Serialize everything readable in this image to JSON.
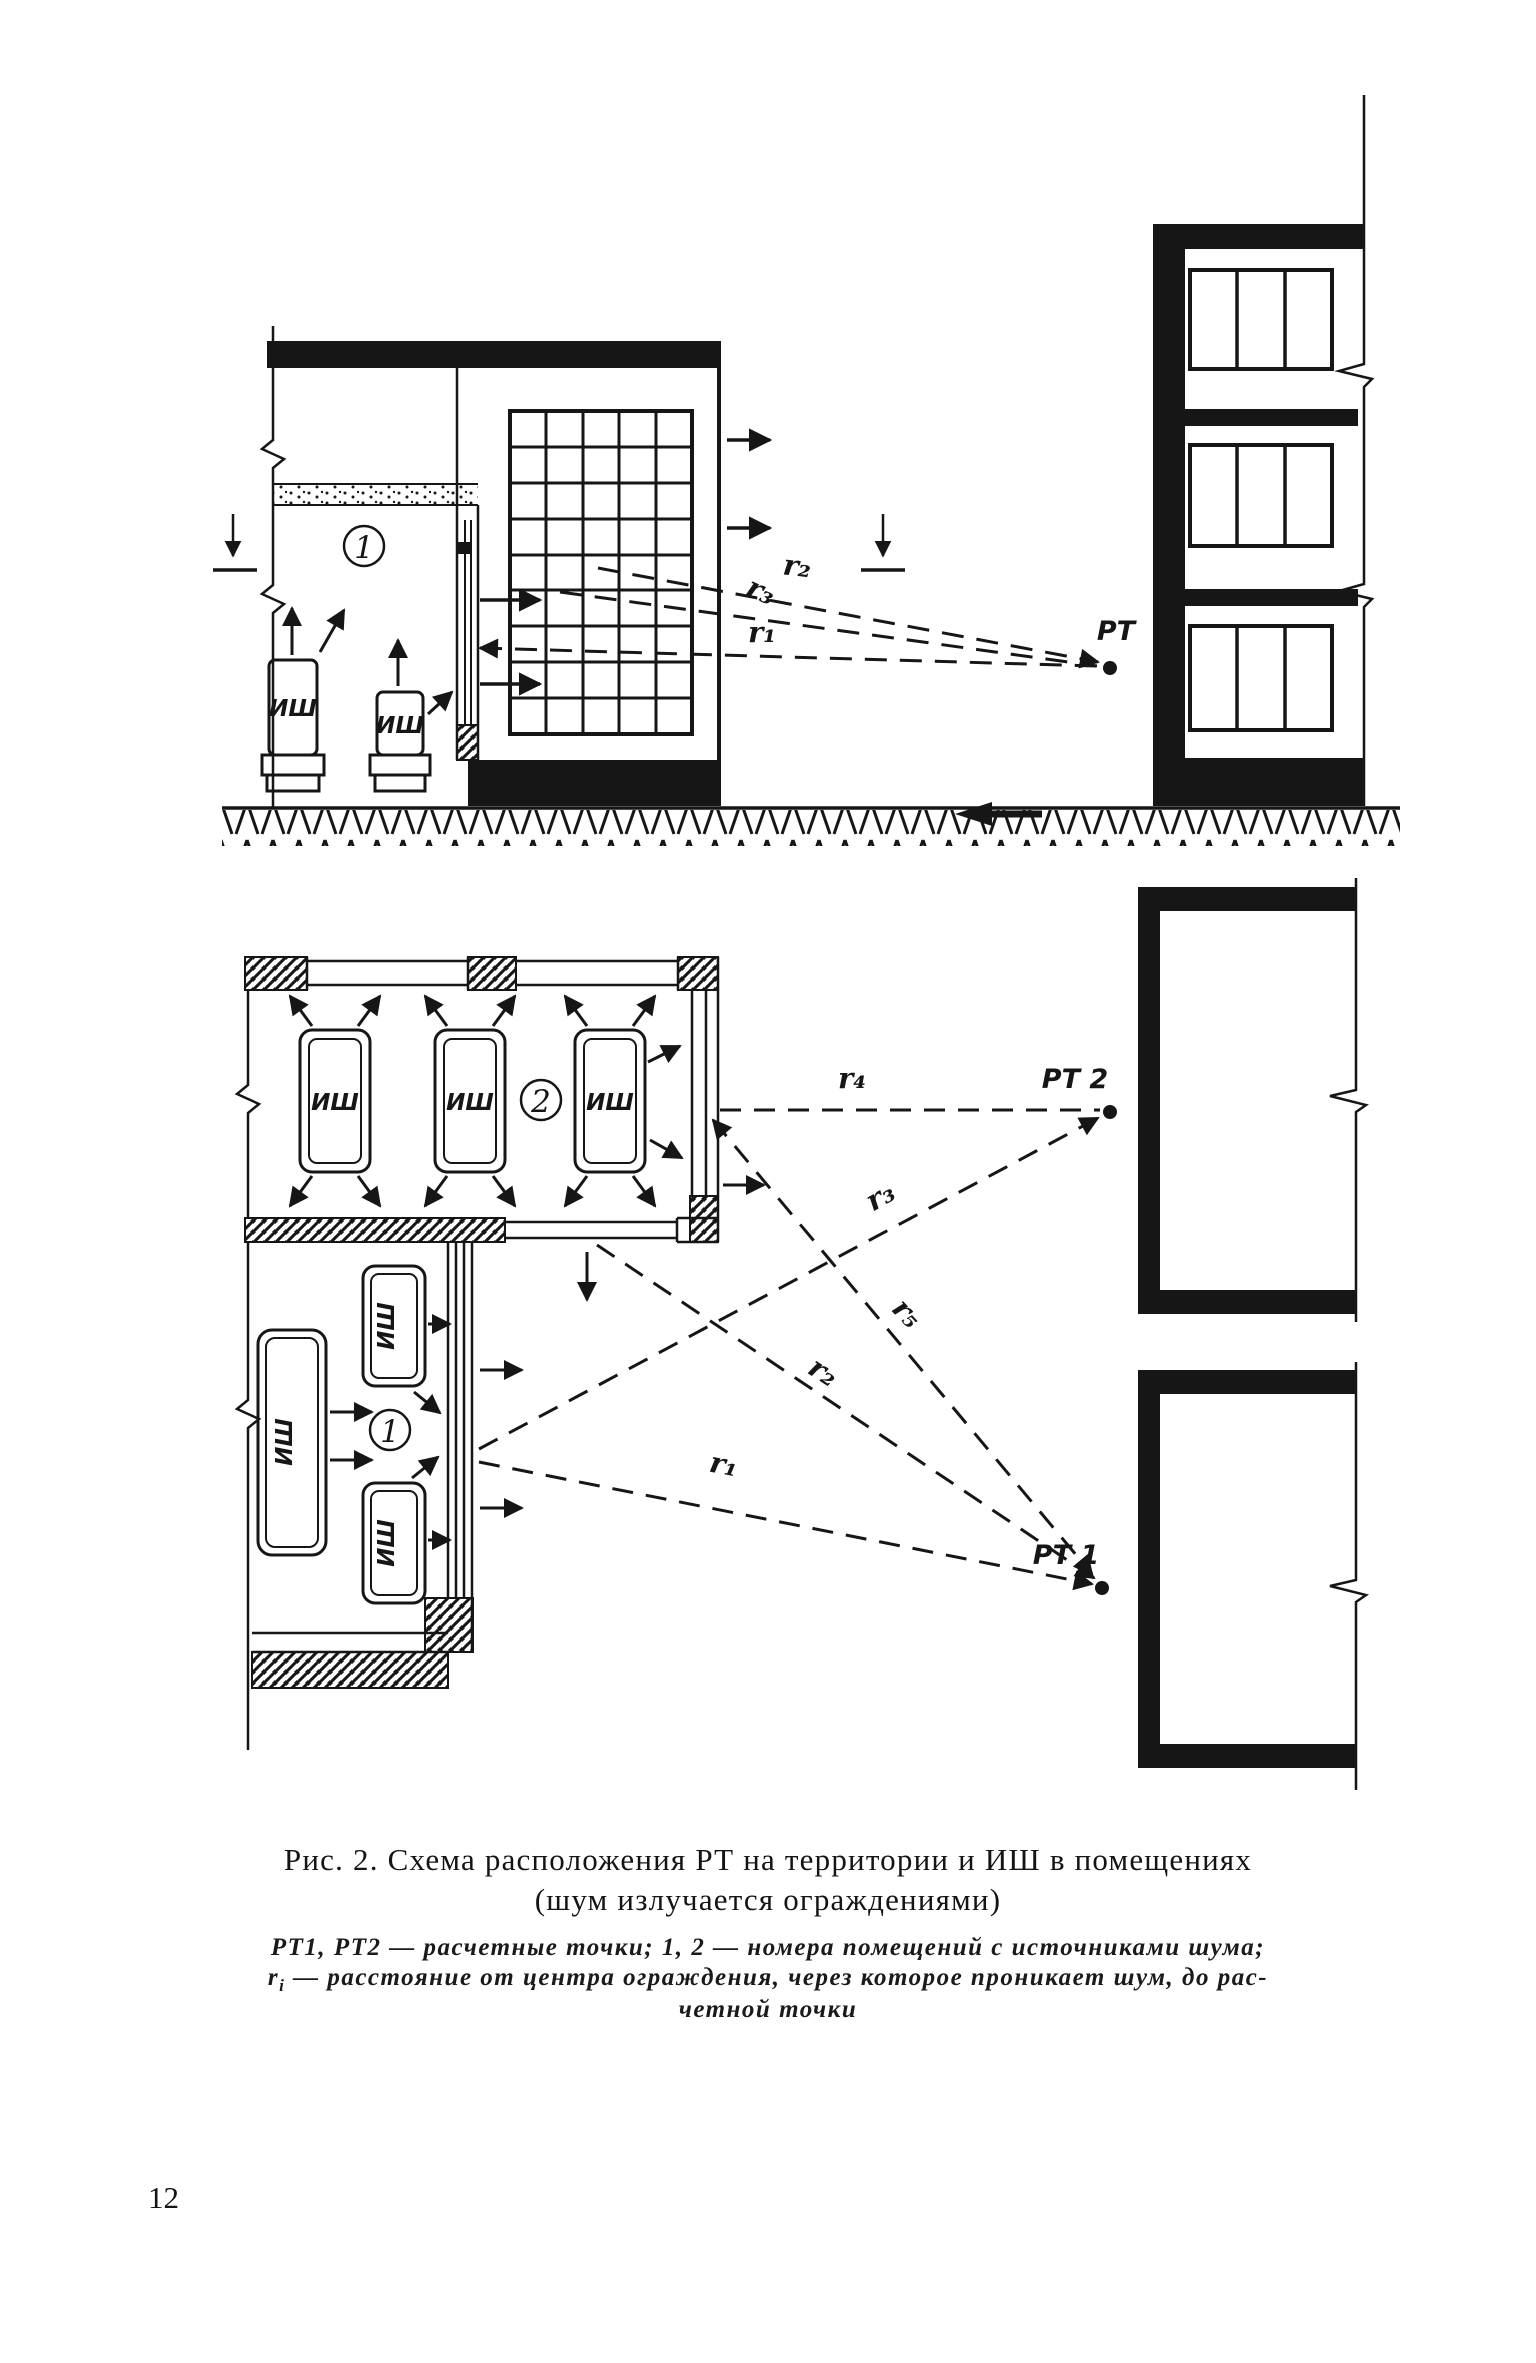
{
  "page_number": "12",
  "caption": {
    "title_line1": "Рис. 2. Схема расположения РТ на территории и ИШ в помещениях",
    "title_line2": "(шум излучается ограждениями)",
    "legend_line1": "РТ1, РТ2 — расчетные точки; 1, 2 — номера помещений с источниками шума;",
    "legend_r": "r",
    "legend_r_sub": "i",
    "legend_line2_rest": " — расстояние от центра ограждения, через которое проникает шум, до рас-",
    "legend_line3": "четной точки"
  },
  "section_view": {
    "source_label": "ИШ",
    "room_number": "1",
    "calc_point": "РТ",
    "r1": "r₁",
    "r2": "r₂",
    "r3": "r₃"
  },
  "plan_view": {
    "source_label": "ИШ",
    "room1_number": "1",
    "room2_number": "2",
    "calc_point1": "РТ 1",
    "calc_point2": "РТ 2",
    "r1": "r₁",
    "r2": "r₂",
    "r3": "r₃",
    "r4": "r₄",
    "r5": "r₅"
  }
}
